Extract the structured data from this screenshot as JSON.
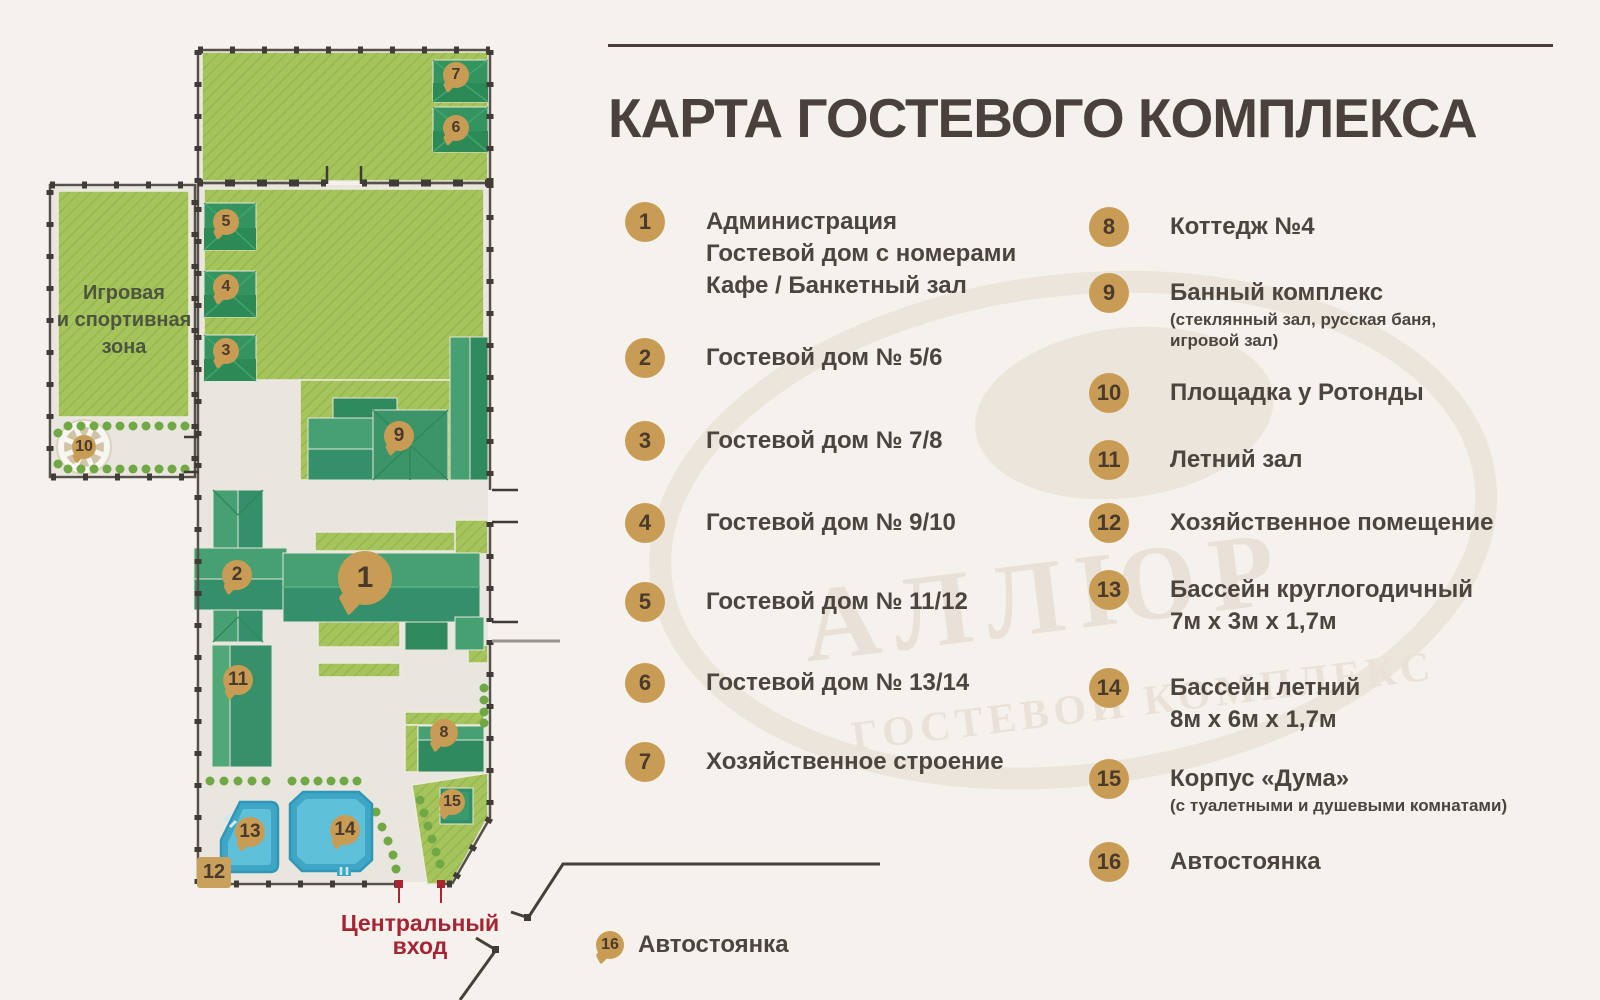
{
  "title": "КАРТА ГОСТЕВОГО КОМПЛЕКСА",
  "colors": {
    "background": "#f5f2ed",
    "accent_gold": "#c89c55",
    "text_dark": "#4c443e",
    "title_dark": "#4a413c",
    "entrance_red": "#a52534",
    "lawn_green": "#a6c45c",
    "building_green": "#3e9b6d",
    "pool_blue": "#49aecb",
    "fence_dark": "#3f3b36"
  },
  "legend": {
    "column1": [
      {
        "num": "1",
        "lines": [
          "Администрация",
          "Гостевой дом с номерами",
          "Кафе / Банкетный зал"
        ]
      },
      {
        "num": "2",
        "lines": [
          "Гостевой дом № 5/6"
        ]
      },
      {
        "num": "3",
        "lines": [
          "Гостевой дом № 7/8"
        ]
      },
      {
        "num": "4",
        "lines": [
          "Гостевой дом № 9/10"
        ]
      },
      {
        "num": "5",
        "lines": [
          "Гостевой дом № 11/12"
        ]
      },
      {
        "num": "6",
        "lines": [
          "Гостевой дом № 13/14"
        ]
      },
      {
        "num": "7",
        "lines": [
          "Хозяйственное строение"
        ]
      }
    ],
    "column2": [
      {
        "num": "8",
        "lines": [
          "Коттедж №4"
        ]
      },
      {
        "num": "9",
        "lines": [
          "Банный комплекс"
        ],
        "sub": [
          "(стеклянный зал, русская баня,",
          "игровой зал)"
        ]
      },
      {
        "num": "10",
        "lines": [
          "Площадка у Ротонды"
        ]
      },
      {
        "num": "11",
        "lines": [
          "Летний зал"
        ]
      },
      {
        "num": "12",
        "lines": [
          "Хозяйственное помещение"
        ]
      },
      {
        "num": "13",
        "lines": [
          "Бассейн круглогодичный",
          "7м х 3м х 1,7м"
        ]
      },
      {
        "num": "14",
        "lines": [
          "Бассейн летний",
          "8м х 6м х 1,7м"
        ]
      },
      {
        "num": "15",
        "lines": [
          "Корпус «Дума»"
        ],
        "sub": [
          "(с туалетными и душевыми комнатами)"
        ]
      },
      {
        "num": "16",
        "lines": [
          "Автостоянка"
        ]
      }
    ]
  },
  "map": {
    "zone_label_lines": [
      "Игровая",
      "и спортивная",
      "зона"
    ],
    "entrance_label_lines": [
      "Центральный",
      "вход"
    ],
    "parking": {
      "num": "16",
      "label": "Автостоянка"
    },
    "utility_area_label": "12",
    "markers": [
      "7",
      "6",
      "5",
      "4",
      "3",
      "10",
      "9",
      "2",
      "1",
      "11",
      "8",
      "15",
      "13",
      "14"
    ]
  },
  "watermark": {
    "brand": "АЛЛЮР",
    "tagline": "ГОСТЕВОЙ КОМПЛЕКС"
  }
}
